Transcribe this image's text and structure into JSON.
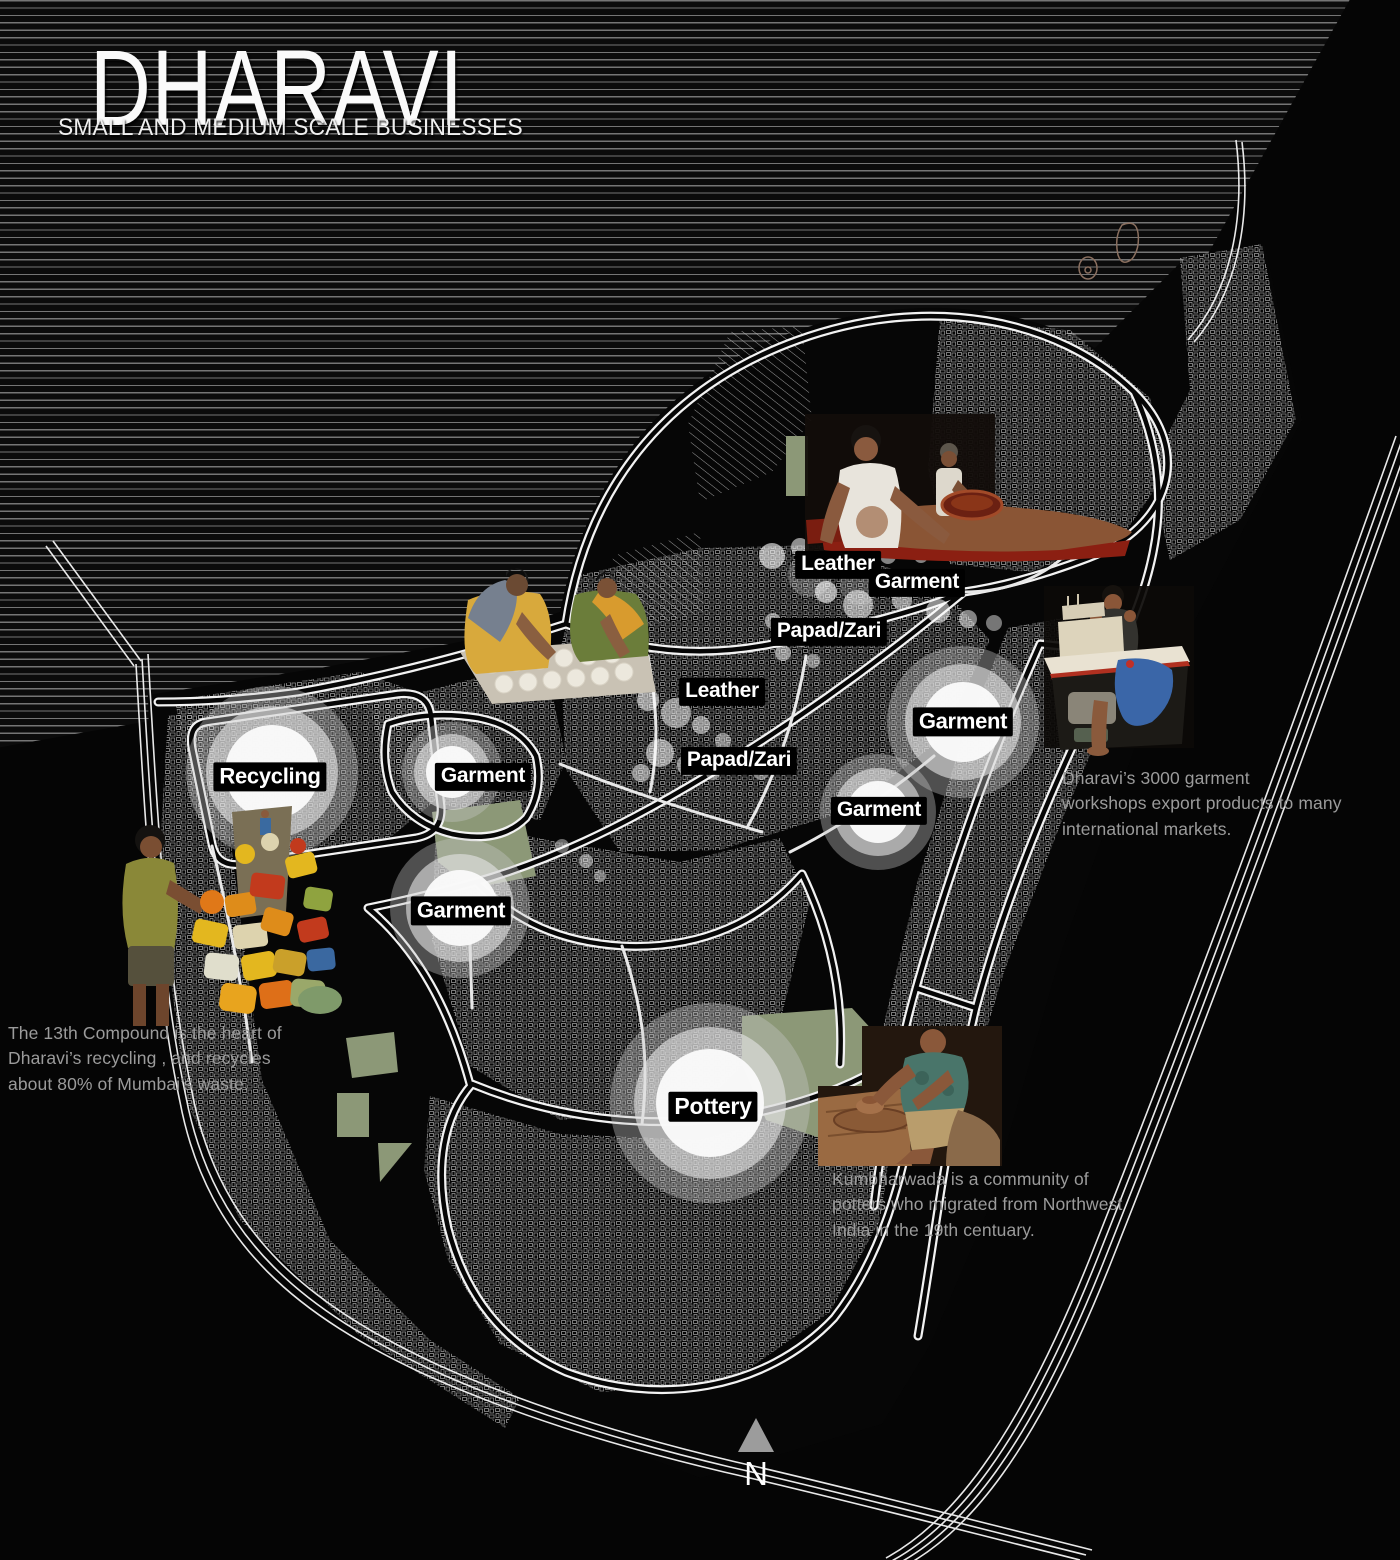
{
  "title": {
    "main": "DHARAVI",
    "subtitle": "SMALL AND MEDIUM SCALE BUSINESSES"
  },
  "map": {
    "labels": [
      {
        "id": "leather-north",
        "text": "Leather"
      },
      {
        "id": "garment-north",
        "text": "Garment"
      },
      {
        "id": "papad-zari-north",
        "text": "Papad/Zari"
      },
      {
        "id": "leather-central",
        "text": "Leather"
      },
      {
        "id": "papad-zari-central",
        "text": "Papad/Zari"
      },
      {
        "id": "recycling",
        "text": "Recycling"
      },
      {
        "id": "garment-west-upper",
        "text": "Garment"
      },
      {
        "id": "garment-east-upper",
        "text": "Garment"
      },
      {
        "id": "garment-east-lower",
        "text": "Garment"
      },
      {
        "id": "garment-west-lower",
        "text": "Garment"
      },
      {
        "id": "pottery",
        "text": "Pottery"
      }
    ],
    "north_label": "N",
    "photos": [
      {
        "id": "leather-workers",
        "depicts": "two men working a leather hide"
      },
      {
        "id": "papad-makers",
        "depicts": "two women rolling papads"
      },
      {
        "id": "garment-worker",
        "depicts": "man at a sewing machine table"
      },
      {
        "id": "recycling-boy",
        "depicts": "boy beside a pile of plastic containers"
      },
      {
        "id": "potter",
        "depicts": "potter at a pottery wheel"
      }
    ]
  },
  "annotations": {
    "garment": "Dharavi’s 3000 garment\nworkshops export products to many\ninternational markets.",
    "recycling": "The 13th Compound is the heart of\nDharavi’s recycling , and recycles\nabout 80% of Mumbai’s waste.",
    "pottery": "Kumbharwada is a community of\npotters who migrated from Northwest\nIndia in the 19th centuary."
  },
  "colors": {
    "background": "#050505",
    "stripe_line": "#757575",
    "map_line": "#ffffff",
    "open_space_green": "#8c9877",
    "label_bg": "#000000",
    "label_text": "#ffffff",
    "annotation_text": "#9b9b9b",
    "north_arrow": "#9c9c9c"
  }
}
